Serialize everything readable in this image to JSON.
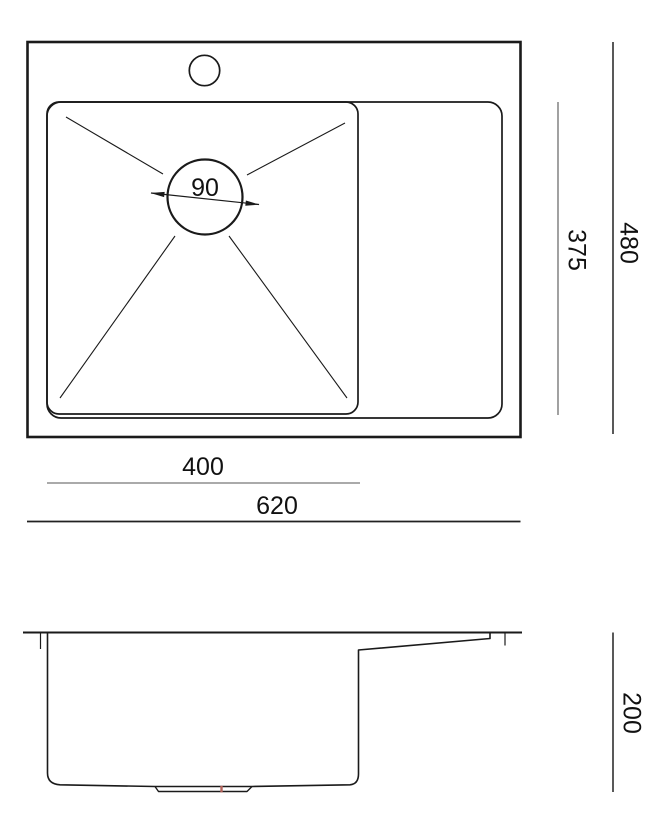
{
  "drawing": {
    "type": "sink-dimension-drawing",
    "views": {
      "top_view": "plan view with bowl, faucet hole and drain",
      "side_view": "section profile"
    }
  },
  "dimensions": {
    "drain_diameter": "90",
    "bowl_width": "400",
    "overall_width": "620",
    "inner_depth": "375",
    "overall_depth": "480",
    "side_height": "200"
  },
  "colors": {
    "background": "#ffffff",
    "drawing_line": "#1a1a1a",
    "dimension_line_light": "#555555",
    "dimension_line_dark": "#222222",
    "text": "#111111",
    "drain_mark": "#b5645c"
  }
}
